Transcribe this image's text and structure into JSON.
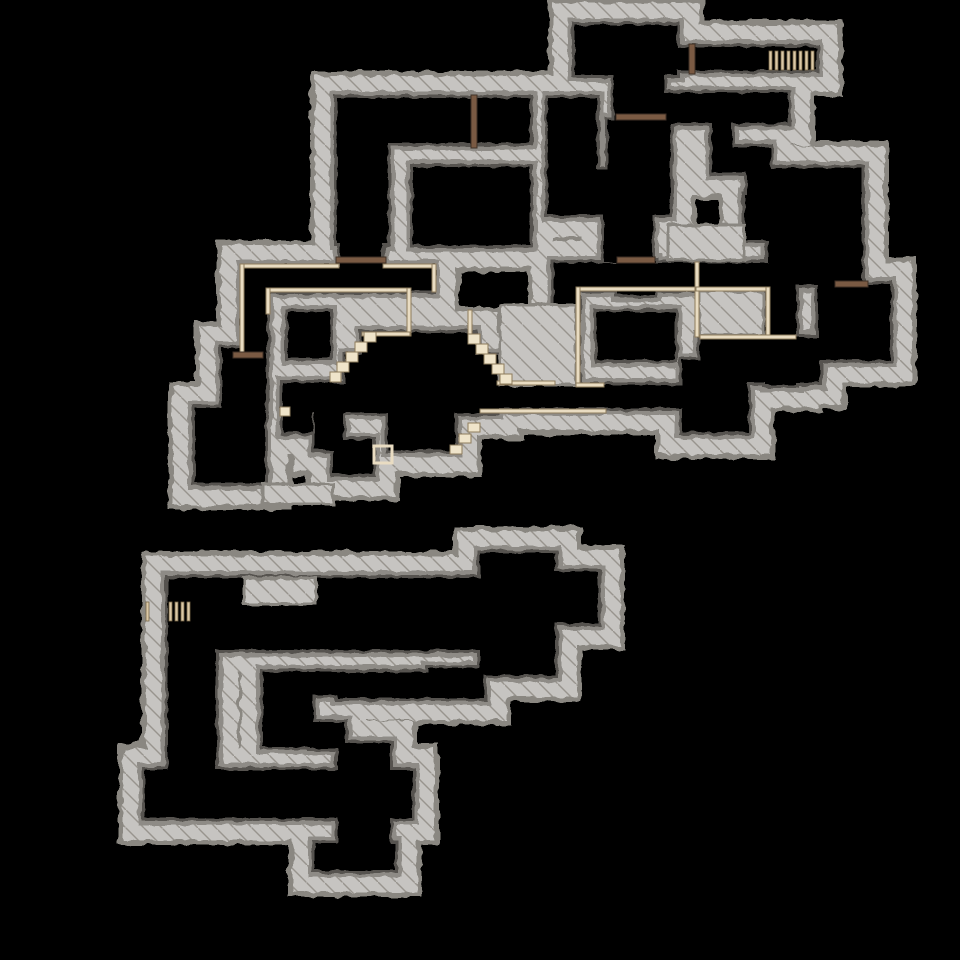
{
  "meta": {
    "view": "dungeon-level-map",
    "description": "Top-down explored dungeon map: hatched stone walls on black, two separate explored sections",
    "width": 960,
    "height": 960
  },
  "palette": {
    "background": "#000000",
    "wall_fill": "#c6c4c1",
    "wall_hatch_line": "#98948e",
    "wall_outer_rim": "#8a8781",
    "floor_shadow": "#8e8b86",
    "floor_rim": "#565350",
    "floor": "#000000",
    "door_fill": "#7a5a43",
    "door_edge": "#3f3026",
    "trim_fill": "#e9dcc2",
    "trim_edge": "#8d7b5c",
    "gate_bar_fill": "#dbc8a6",
    "gate_bar_edge": "#776748",
    "step_fill": "#efe4ca"
  },
  "map": {
    "floors": [
      [
        575,
        25,
        102,
        50
      ],
      [
        677,
        47,
        139,
        23
      ],
      [
        614,
        75,
        50,
        48
      ],
      [
        608,
        120,
        62,
        95
      ],
      [
        548,
        98,
        49,
        117
      ],
      [
        548,
        170,
        122,
        45
      ],
      [
        604,
        210,
        48,
        52
      ],
      [
        618,
        260,
        37,
        35
      ],
      [
        337,
        98,
        193,
        45
      ],
      [
        337,
        143,
        51,
        100
      ],
      [
        413,
        167,
        117,
        78
      ],
      [
        340,
        240,
        42,
        30
      ],
      [
        243,
        267,
        190,
        24
      ],
      [
        243,
        267,
        24,
        86
      ],
      [
        222,
        348,
        44,
        62
      ],
      [
        195,
        408,
        70,
        75
      ],
      [
        288,
        312,
        42,
        46
      ],
      [
        362,
        333,
        113,
        27
      ],
      [
        345,
        355,
        153,
        30
      ],
      [
        286,
        383,
        211,
        30
      ],
      [
        283,
        383,
        30,
        49
      ],
      [
        388,
        413,
        67,
        37
      ],
      [
        333,
        440,
        40,
        34
      ],
      [
        315,
        402,
        28,
        48
      ],
      [
        497,
        385,
        193,
        23
      ],
      [
        556,
        263,
        240,
        27
      ],
      [
        554,
        263,
        24,
        125
      ],
      [
        766,
        287,
        30,
        98
      ],
      [
        597,
        312,
        78,
        48
      ],
      [
        700,
        337,
        120,
        46
      ],
      [
        682,
        360,
        66,
        72
      ],
      [
        818,
        284,
        72,
        76
      ],
      [
        768,
        168,
        94,
        117
      ],
      [
        745,
        195,
        30,
        45
      ],
      [
        697,
        93,
        91,
        30
      ],
      [
        660,
        93,
        52,
        30
      ],
      [
        712,
        118,
        20,
        55
      ],
      [
        732,
        147,
        38,
        26
      ],
      [
        747,
        170,
        21,
        40
      ],
      [
        168,
        578,
        317,
        72
      ],
      [
        480,
        553,
        75,
        122
      ],
      [
        555,
        572,
        43,
        51
      ],
      [
        168,
        640,
        48,
        132
      ],
      [
        145,
        770,
        267,
        48
      ],
      [
        263,
        672,
        50,
        75
      ],
      [
        310,
        672,
        30,
        23
      ],
      [
        337,
        672,
        93,
        26
      ],
      [
        428,
        668,
        56,
        30
      ],
      [
        310,
        722,
        35,
        26
      ],
      [
        338,
        743,
        52,
        102
      ],
      [
        315,
        843,
        80,
        27
      ]
    ],
    "wall_patches": [
      [
        244,
        578,
        72,
        26
      ],
      [
        500,
        305,
        76,
        80
      ],
      [
        668,
        225,
        76,
        35
      ],
      [
        263,
        484,
        70,
        20
      ],
      [
        699,
        291,
        64,
        44
      ]
    ],
    "doors": [
      {
        "x": 471,
        "y": 95,
        "w": 6,
        "h": 53,
        "orientation": "vertical"
      },
      {
        "x": 616,
        "y": 114,
        "w": 50,
        "h": 6,
        "orientation": "horizontal"
      },
      {
        "x": 617,
        "y": 257,
        "w": 38,
        "h": 6,
        "orientation": "horizontal"
      },
      {
        "x": 336,
        "y": 257,
        "w": 50,
        "h": 6,
        "orientation": "horizontal"
      },
      {
        "x": 233,
        "y": 352,
        "w": 30,
        "h": 6,
        "orientation": "horizontal"
      },
      {
        "x": 835,
        "y": 281,
        "w": 33,
        "h": 6,
        "orientation": "horizontal"
      },
      {
        "x": 689,
        "y": 44,
        "w": 6,
        "h": 30,
        "orientation": "vertical"
      }
    ],
    "gates": [
      {
        "bar_x": [
          769,
          775,
          781,
          787,
          793,
          799,
          805,
          811
        ],
        "y": 51,
        "bar_w": 3,
        "bar_h": 19
      },
      {
        "bar_x": [
          146,
          169,
          175,
          181,
          187
        ],
        "y": 602,
        "bar_w": 3,
        "bar_h": 19
      }
    ],
    "trim_lines": [
      [
        243,
        264,
        96,
        4
      ],
      [
        383,
        264,
        52,
        4
      ],
      [
        432,
        264,
        4,
        28
      ],
      [
        240,
        264,
        4,
        92
      ],
      [
        266,
        288,
        144,
        4
      ],
      [
        407,
        288,
        4,
        48
      ],
      [
        362,
        332,
        48,
        4
      ],
      [
        266,
        288,
        4,
        26
      ],
      [
        468,
        310,
        4,
        26
      ],
      [
        480,
        409,
        126,
        4
      ],
      [
        576,
        287,
        124,
        4
      ],
      [
        576,
        287,
        4,
        100
      ],
      [
        576,
        383,
        28,
        4
      ],
      [
        695,
        262,
        4,
        75
      ],
      [
        696,
        287,
        74,
        4
      ],
      [
        766,
        287,
        4,
        52
      ],
      [
        700,
        335,
        96,
        4
      ],
      [
        497,
        381,
        58,
        4
      ]
    ],
    "steps": [
      [
        364,
        332,
        12,
        10
      ],
      [
        355,
        342,
        12,
        10
      ],
      [
        346,
        352,
        12,
        10
      ],
      [
        337,
        362,
        12,
        10
      ],
      [
        330,
        372,
        11,
        10
      ],
      [
        468,
        334,
        12,
        10
      ],
      [
        476,
        344,
        12,
        10
      ],
      [
        484,
        354,
        12,
        10
      ],
      [
        492,
        364,
        12,
        10
      ],
      [
        500,
        374,
        12,
        10
      ],
      [
        468,
        423,
        12,
        9
      ],
      [
        459,
        434,
        12,
        9
      ],
      [
        450,
        445,
        12,
        9
      ],
      [
        280,
        407,
        10,
        9
      ]
    ],
    "alcoves": [
      [
        374,
        446,
        18,
        17
      ]
    ]
  }
}
